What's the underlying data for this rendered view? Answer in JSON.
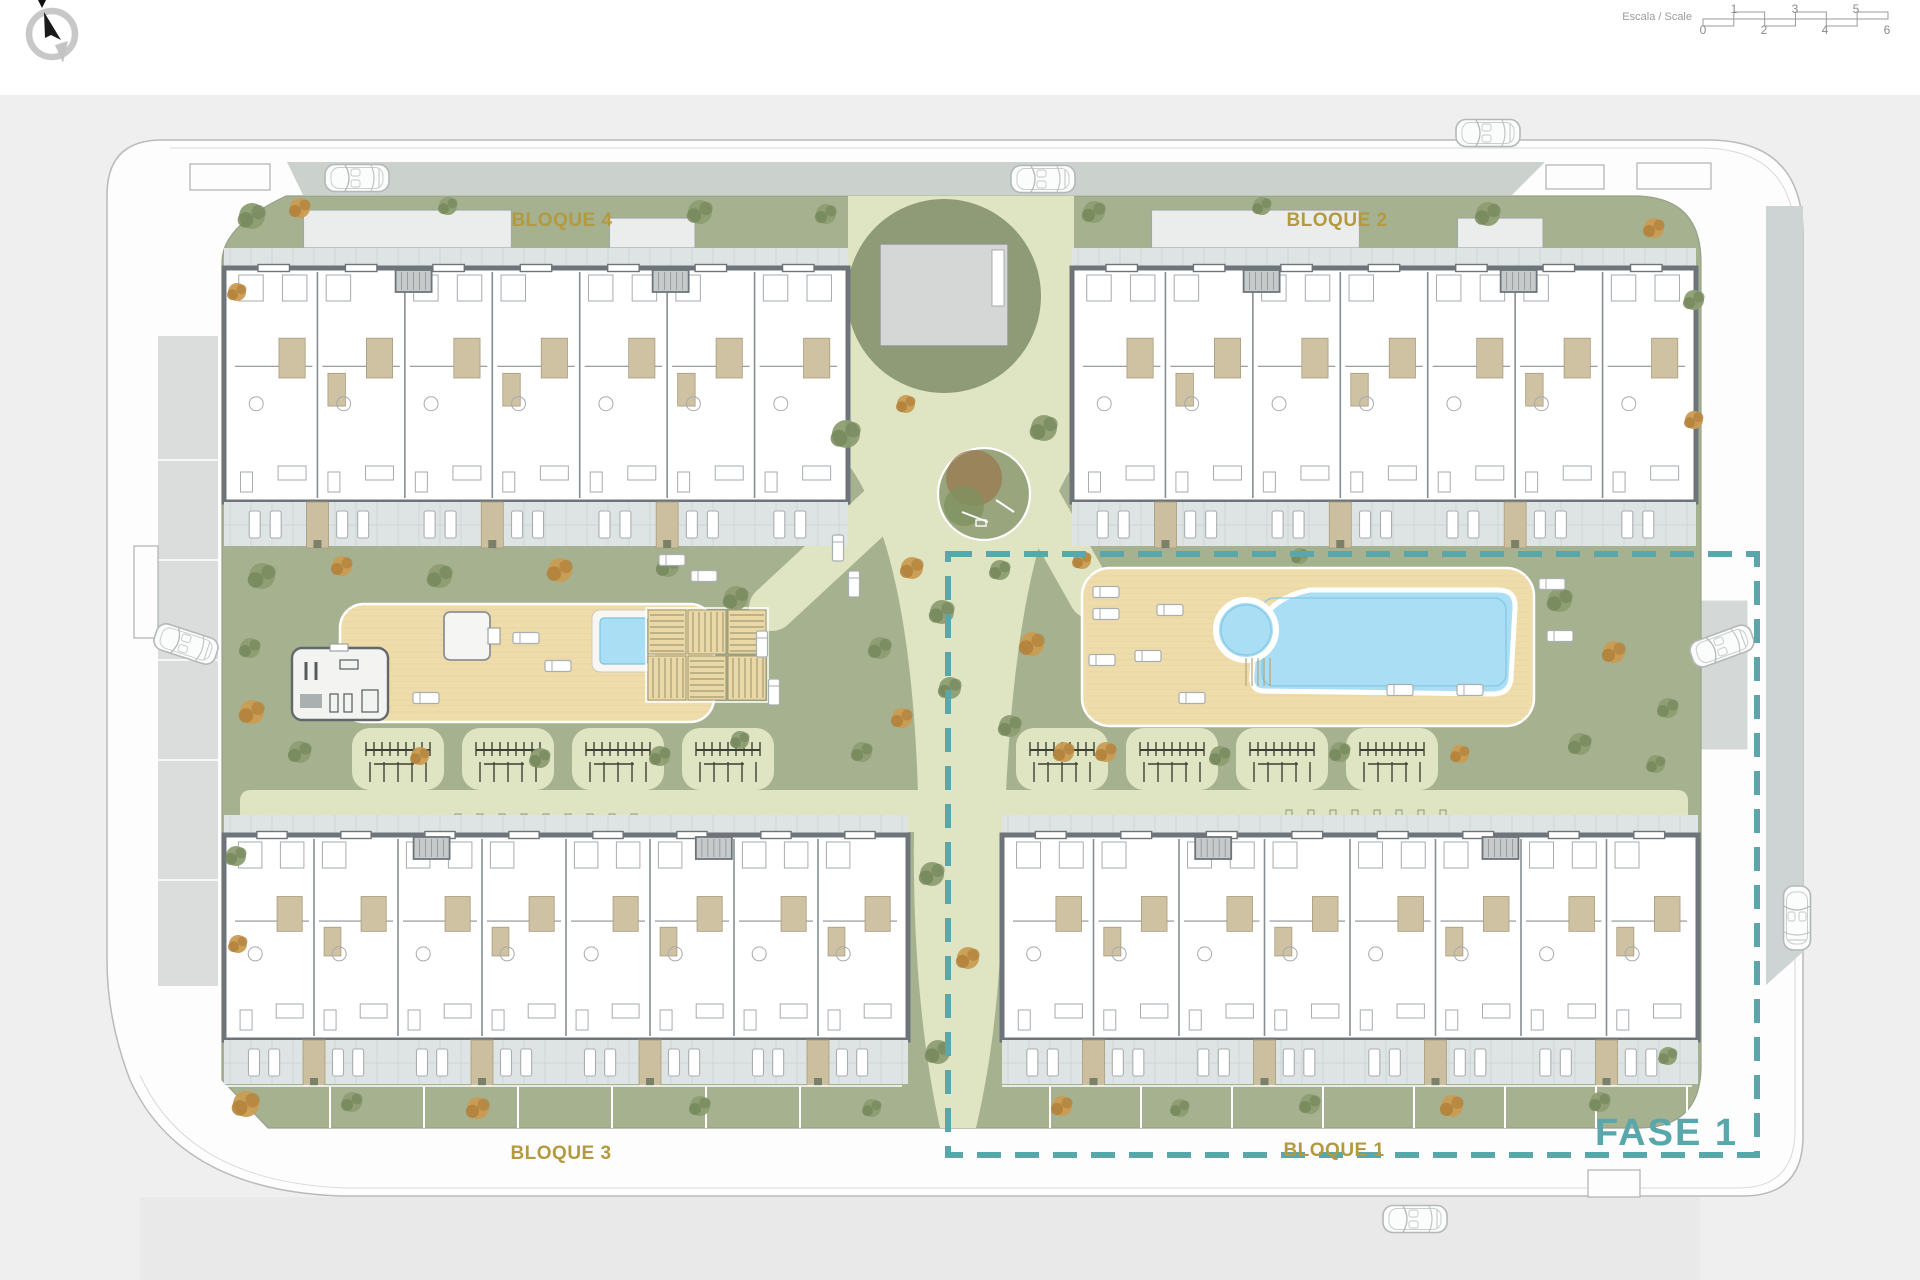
{
  "blocks": [
    {
      "id": "bloque-4",
      "label": "BLOQUE 4"
    },
    {
      "id": "bloque-2",
      "label": "BLOQUE 2"
    },
    {
      "id": "bloque-3",
      "label": "BLOQUE 3"
    },
    {
      "id": "bloque-1",
      "label": "BLOQUE 1"
    }
  ],
  "phase": {
    "label": "FASE 1"
  },
  "scale_bar": {
    "label": "Escala / Scale",
    "top_numbers": [
      "1",
      "3",
      "5"
    ],
    "bottom_numbers": [
      "0",
      "2",
      "4",
      "6"
    ]
  },
  "compass": {
    "name": "north-arrow"
  },
  "colors": {
    "block_label": "#b3993f",
    "phase_teal": "#5aa7ab",
    "grass": "#a6b18f",
    "path_cream": "#dfe4c3",
    "deck_tan": "#efdcab",
    "pool_blue": "#a9def5",
    "terrace_tile": "#dde4e3",
    "bath_tan": "#cec2a3",
    "wall_gray": "#6e757a",
    "road_gray": "#cbd1cd"
  }
}
